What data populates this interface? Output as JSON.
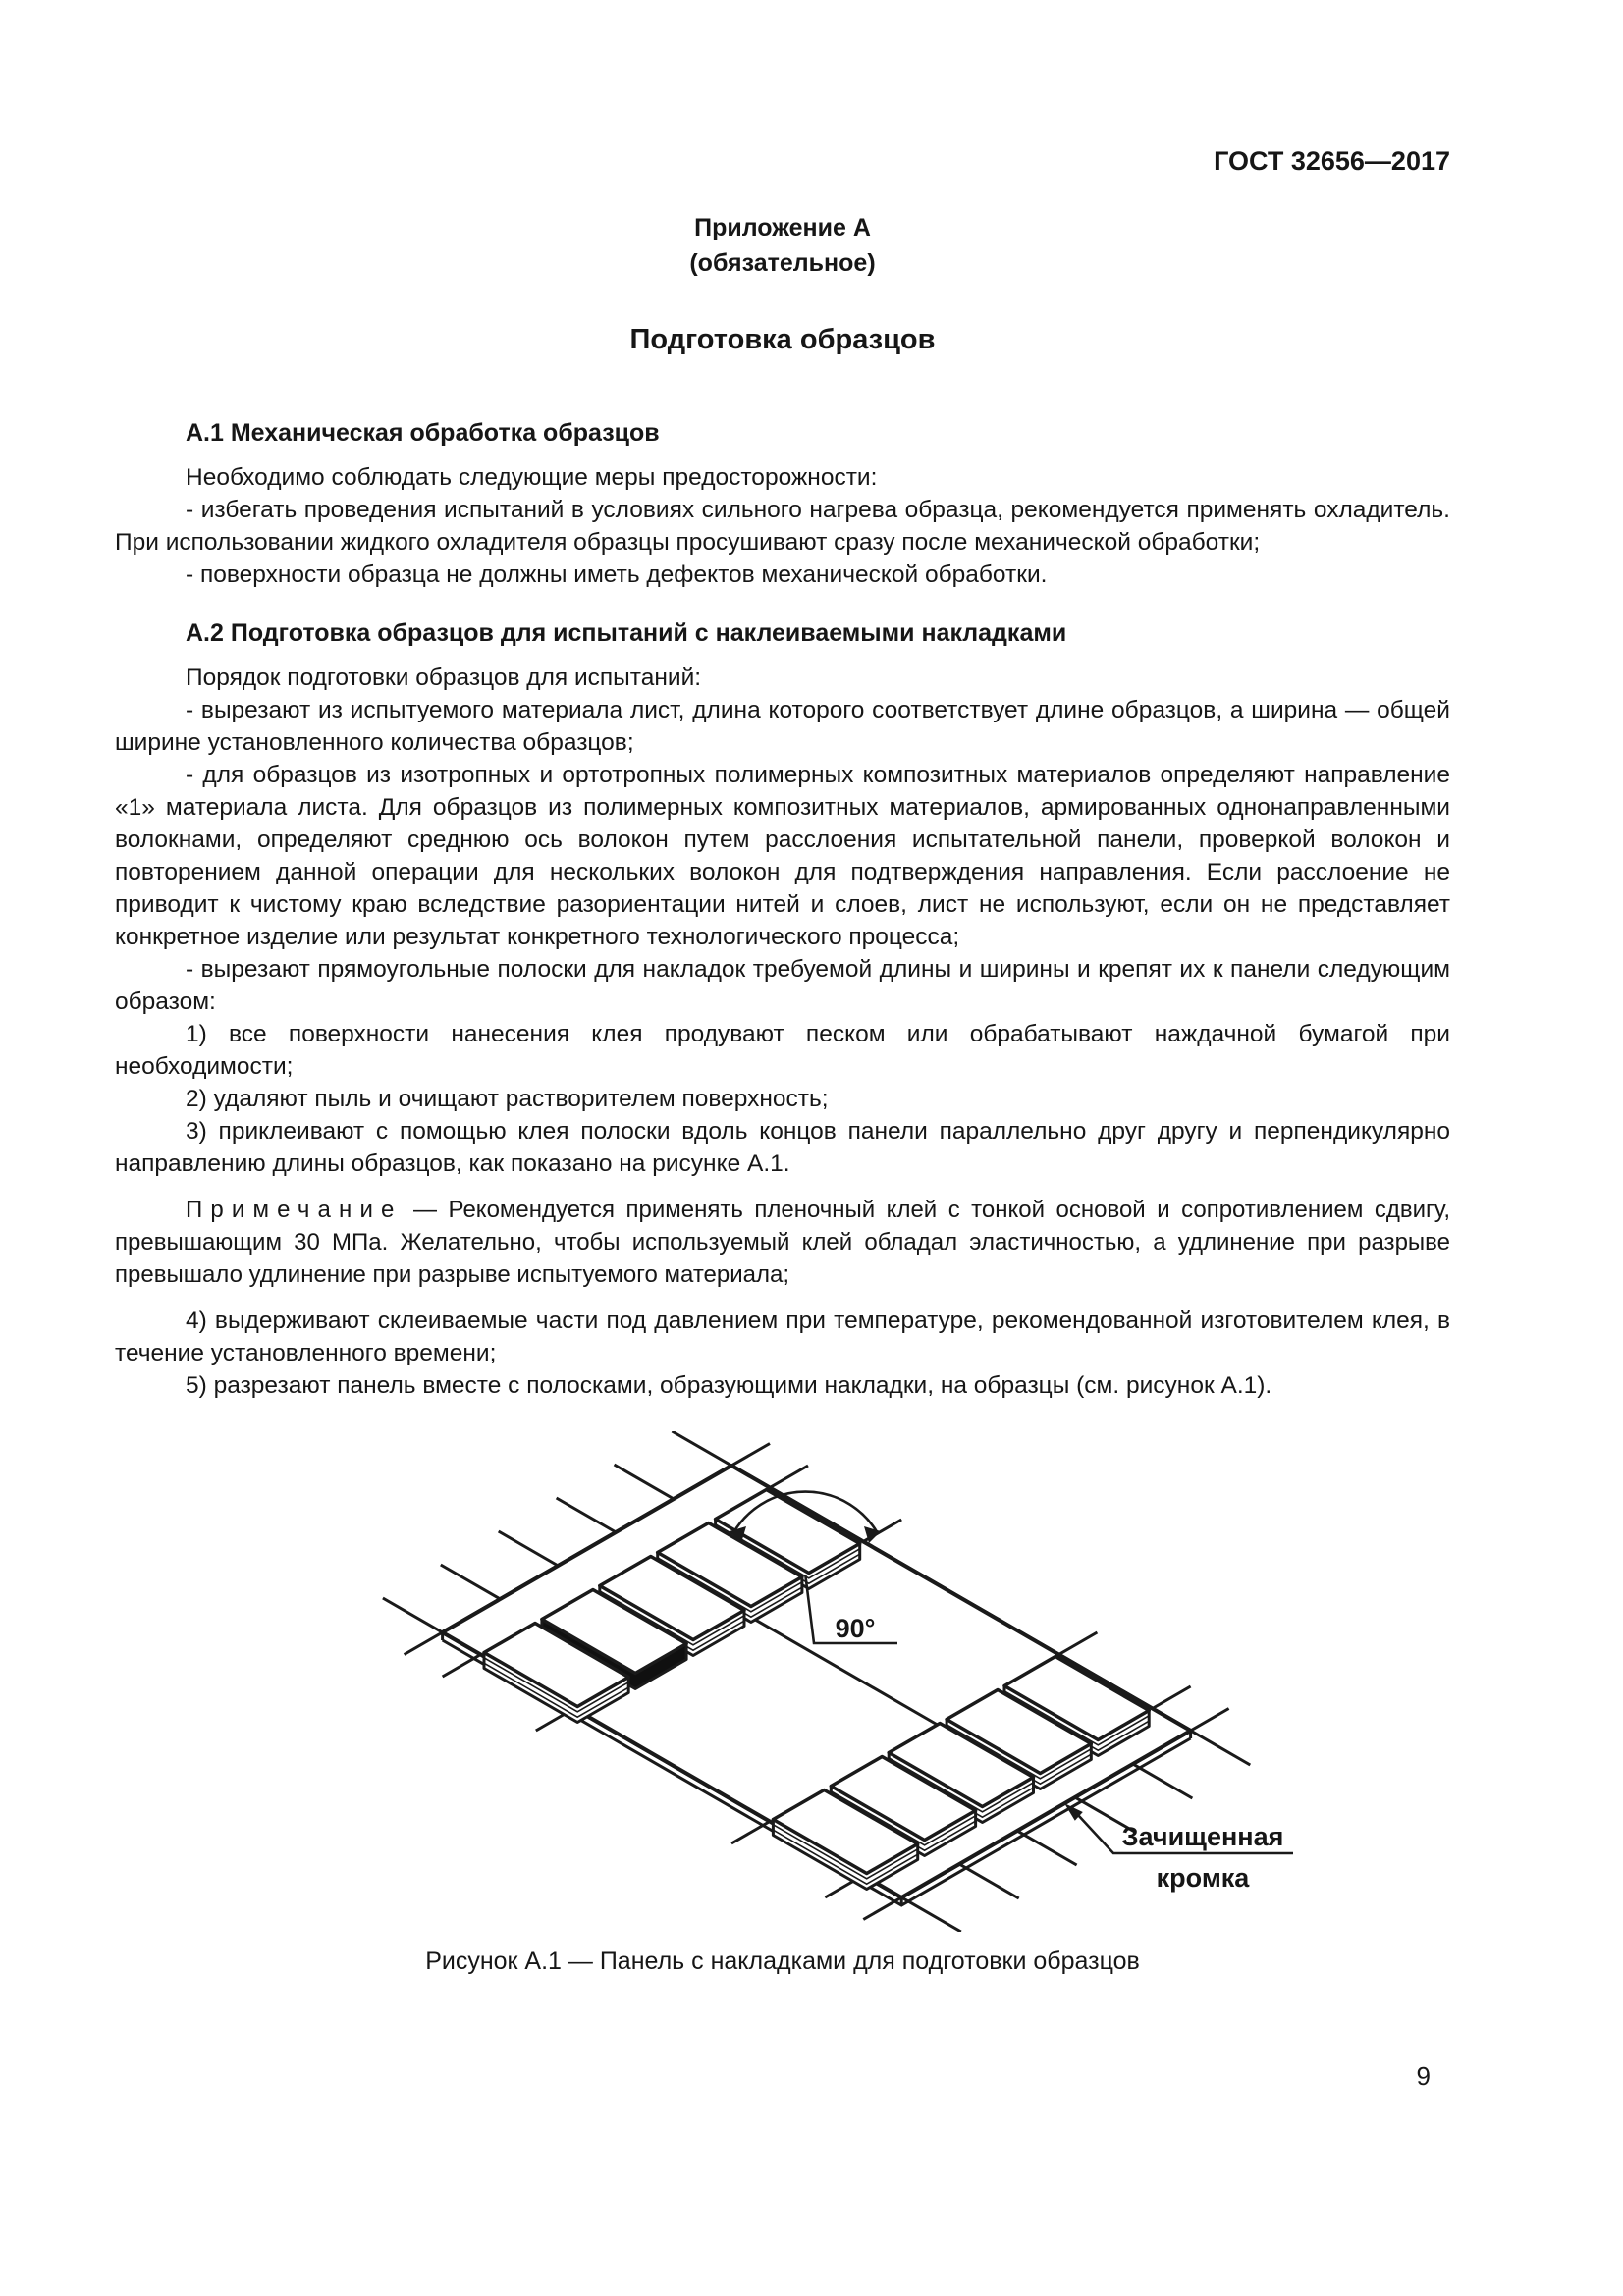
{
  "page": {
    "standard": "ГОСТ 32656—2017",
    "number": "9"
  },
  "appendix": {
    "label": "Приложение А",
    "status": "(обязательное)",
    "title": "Подготовка образцов"
  },
  "section_a1": {
    "heading": "А.1  Механическая обработка образцов",
    "p1": "Необходимо соблюдать следующие меры предосторожности:",
    "p2": "- избегать проведения испытаний в условиях сильного нагрева образца, рекомендуется применять охладитель. При использовании жидкого охладителя образцы просушивают сразу после механической обработки;",
    "p3": "- поверхности образца не должны иметь дефектов механической обработки."
  },
  "section_a2": {
    "heading": "А.2  Подготовка образцов для испытаний с наклеиваемыми накладками",
    "p1": "Порядок подготовки образцов для испытаний:",
    "p2": "- вырезают из испытуемого материала лист, длина которого соответствует длине образцов, а ширина — общей ширине установленного количества образцов;",
    "p3": "- для образцов из изотропных и ортотропных полимерных композитных материалов определяют направление «1» материала листа. Для образцов из полимерных композитных материалов, армированных однонаправленными волокнами, определяют среднюю ось волокон путем расслоения испытательной панели, проверкой волокон и повторением данной операции для нескольких волокон для подтверждения направления. Если расслоение не приводит к чистому краю вследствие разориентации нитей и слоев, лист не используют, если он не представляет конкретное изделие или результат конкретного технологического процесса;",
    "p4": "- вырезают прямоугольные полоски для накладок требуемой длины и ширины и крепят их к панели следующим образом:",
    "item1": "1)  все поверхности нанесения клея продувают песком или обрабатывают наждачной бумагой при необходимости;",
    "item2": "2)  удаляют пыль и очищают растворителем поверхность;",
    "item3": "3)  приклеивают с помощью клея полоски вдоль концов панели параллельно друг другу и перпендикулярно направлению длины образцов, как показано на рисунке А.1.",
    "note_label": "Примечание",
    "note_text": " — Рекомендуется применять пленочный клей с тонкой основой и сопротивлением сдвигу, превышающим 30 МПа. Желательно, чтобы используемый клей обладал эластичностью, а удлинение при разрыве превышало удлинение при разрыве испытуемого материала;",
    "item4": "4)  выдерживают склеиваемые части под давлением при температуре, рекомендованной изготовителем клея, в течение установленного времени;",
    "item5": "5)  разрезают панель вместе с полосками, образующими накладки, на образцы (см. рисунок А.1)."
  },
  "figure": {
    "angle_label": "90°",
    "edge_label_line1": "Зачищенная",
    "edge_label_line2": "кромка",
    "caption": "Рисунок А.1 — Панель с накладками для подготовки образцов"
  }
}
